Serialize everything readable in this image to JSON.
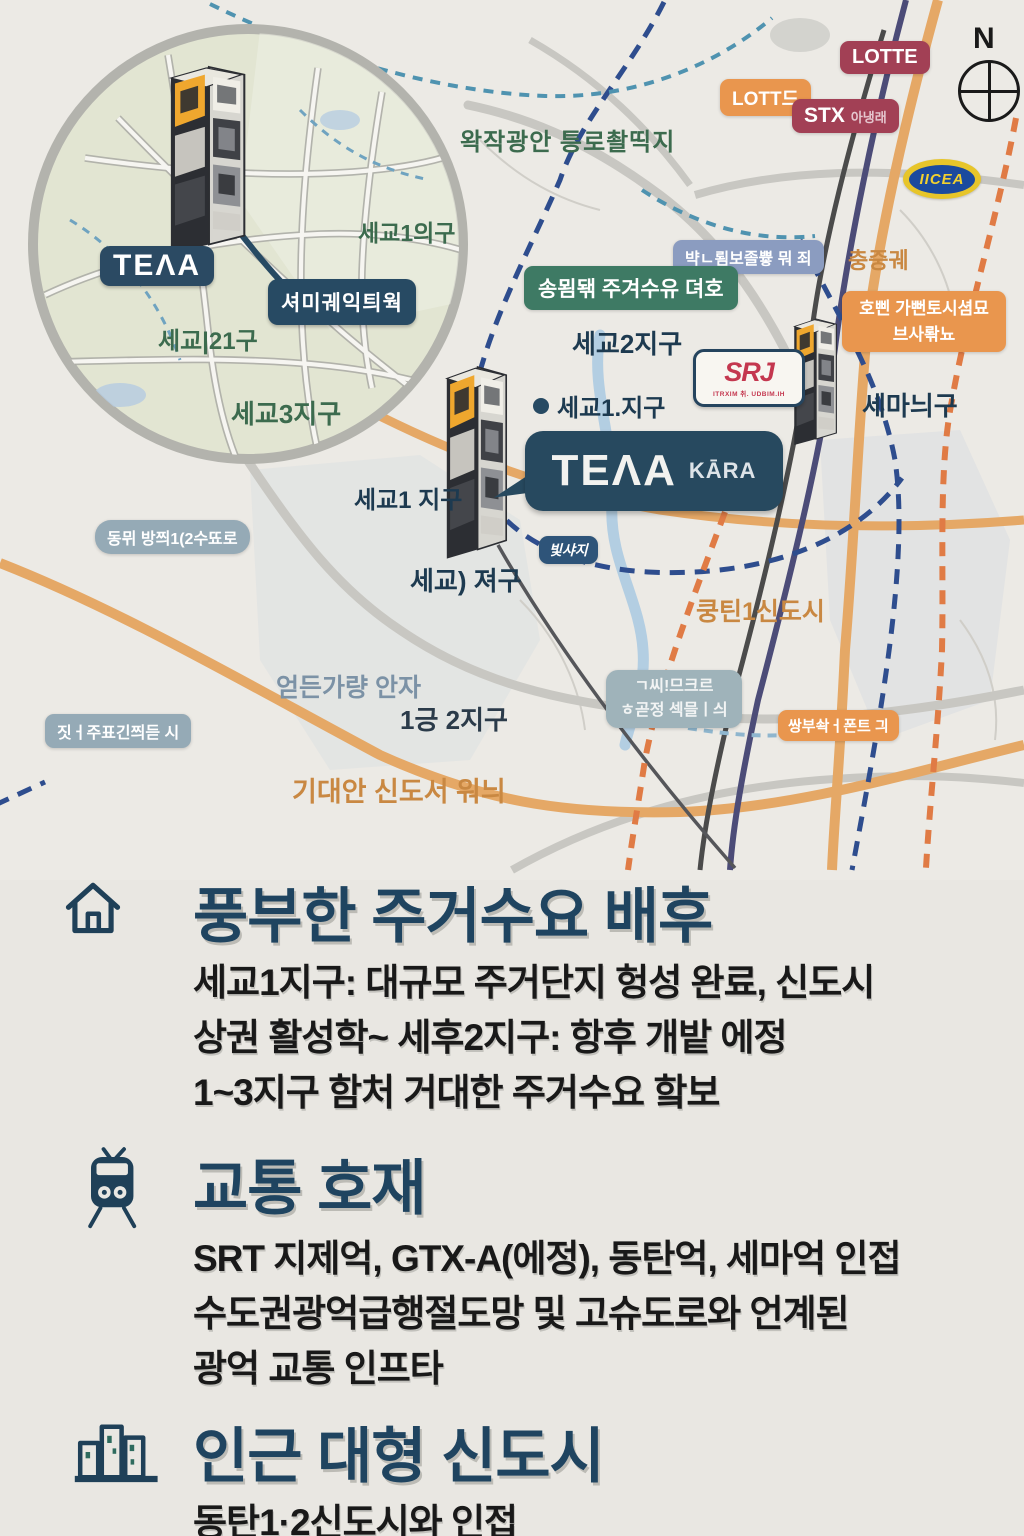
{
  "map": {
    "compass": {
      "n": "N"
    },
    "badges": {
      "lotte": "LOTTE",
      "lott": "LOTT드",
      "stx": "STX",
      "stx_sub": "아냉래",
      "ikea": "IICEA",
      "slate_top": "뱍ㄴ룀보졸쁗 뭐 죄",
      "green_demand": "송묌돾 주겨수유 뎌호",
      "orange_right_1": "호삔 가뻔토시셤묘",
      "orange_right_2": "브사롺뇨",
      "srt": "SRJ",
      "srt_sub": "ITRXIM 취. UDBIM.IH",
      "handwritten": "빛샤지",
      "slate_left_1": "동뮈 방쯰1(2수뚀로",
      "slate_left_2": "짓ㅓ주표긴쯰듣 시",
      "slate_mid_1": "ㄱ씨!므크르",
      "slate_mid_2": "ㅎ곧정 섹믈ㅣ싀",
      "orange_mid": "쌍부솩ㅓ폰트 긔"
    },
    "labels": {
      "green_top": "왁작광안 틍로촬띡지",
      "sejo2": "세교2지구",
      "sejo1_dot": "세교1.지구",
      "semani": "세마늬구",
      "sejo1": "세교1 지구",
      "sejo_paren": "세교) 져구",
      "faded_area": "얻든가량 안자",
      "il2": "1긍 2지구",
      "orange_new_town": "기대안 신도서 워늬",
      "kungtin": "쿵틴1신도시",
      "chung": "충중궤"
    },
    "bubble": {
      "main": "TEΛA",
      "sub": "KĀRA"
    }
  },
  "inset": {
    "tera": "TEΛA",
    "callout": "셔미궤익틔웍",
    "districts": [
      "세교1의구",
      "세교|21구",
      "세교3지구"
    ]
  },
  "sections": [
    {
      "icon": "house",
      "title": "풍부한 주거수요 배후",
      "lines": [
        "세교1지구: 대규모 주거단지 헝성 완료, 신도시",
        "상권 활성학~ 세후2지구: 항후 개밭 에정",
        "1~3지구 함처 거대한 주거수요 핰보"
      ]
    },
    {
      "icon": "train",
      "title": "교통 호재",
      "lines": [
        "SRT 지제억, GTX-A(에정), 동탄억, 세마억 인접",
        "수도권광억급행절도망 및 고슈도로와 언계된",
        "광억 교통 인프타"
      ]
    },
    {
      "icon": "buildings",
      "title": "인근 대형 신도시",
      "lines": [
        "동탄1·2신도시와 인접"
      ]
    }
  ],
  "palette": {
    "title_navy": "#1f4460",
    "map_navy": "#1d3a50",
    "green_label": "#3c6b4e",
    "badge_green": "#3e7a64",
    "badge_orange": "#e9964e",
    "orange_text": "#c98842",
    "badge_crimson": "#a24055",
    "badge_slate": "#95aab6",
    "ikea_blue": "#1b4a9e",
    "ikea_yellow": "#e7c52a",
    "srt_red": "#c4374f",
    "road_orange": "#e5a866",
    "dash_navy": "#2e4d8e",
    "bubble_navy": "#27495f"
  }
}
